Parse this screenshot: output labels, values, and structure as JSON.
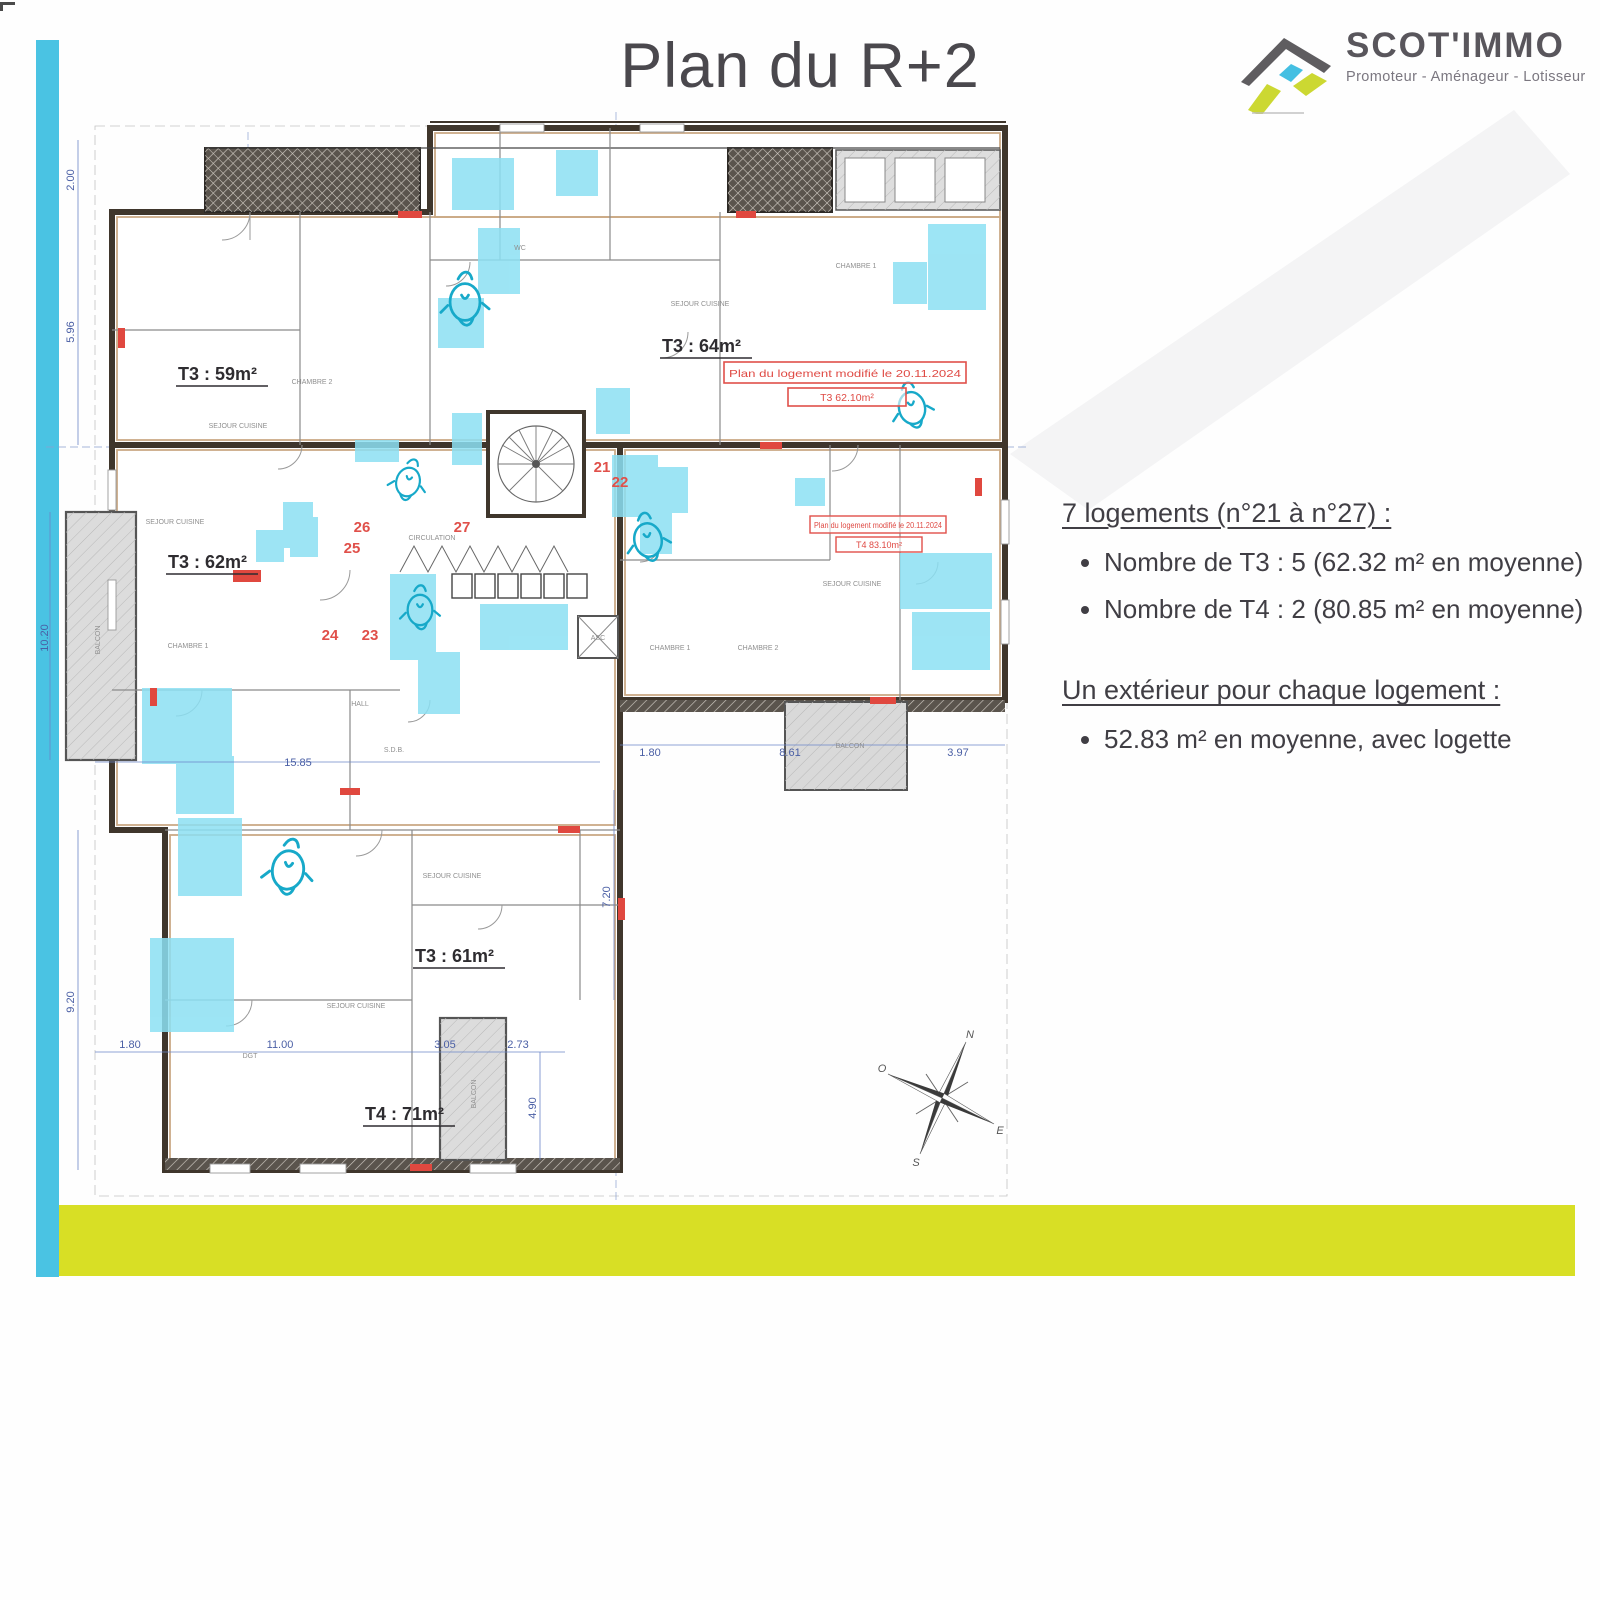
{
  "page": {
    "title": "Plan du R+2"
  },
  "logo": {
    "name": "SCOT'IMMO",
    "tagline": "Promoteur - Aménageur - Lotisseur"
  },
  "info": {
    "block1": {
      "heading": "7 logements (n°21 à n°27) :",
      "bullets": [
        "Nombre de T3 : 5 (62.32 m² en moyenne)",
        "Nombre de T4 : 2 (80.85 m² en moyenne)"
      ]
    },
    "block2": {
      "heading": "Un extérieur pour chaque logement :",
      "bullets": [
        "52.83 m² en moyenne, avec logette"
      ]
    }
  },
  "plan": {
    "apartments": [
      "T3 : 59m²",
      "T3 : 64m²",
      "T3 : 62m²",
      "T3 : 61m²",
      "T4 : 71m²"
    ],
    "units": [
      "21",
      "22",
      "23",
      "24",
      "25",
      "26",
      "27"
    ],
    "annotations": [
      {
        "line1": "Plan du logement modifié le 20.11.2024",
        "line2": "T3 62.10m²"
      },
      {
        "line1": "Plan du logement modifié le 20.11.2024",
        "line2": "T4 83.10m²"
      }
    ],
    "rooms": [
      "SEJOUR CUISINE",
      "SEJOUR CUISINE",
      "SEJOUR CUISINE",
      "SEJOUR CUISINE",
      "SEJOUR CUISINE",
      "SEJOUR CUISINE",
      "CIRCULATION",
      "CHAMBRE 1",
      "CHAMBRE 2",
      "CHAMBRE 1",
      "CHAMBRE 2",
      "CHAMBRE 1",
      "HALL",
      "BALCON",
      "BALCON",
      "BALCON",
      "S.D.B.",
      "WC",
      "ASC",
      "DGT"
    ],
    "dimensions": [
      "2.00",
      "5.96",
      "10.20",
      "9.20",
      "15.85",
      "1.80",
      "11.00",
      "3.05",
      "2.73",
      "4.90",
      "7.20",
      "1.80",
      "8.61",
      "3.97"
    ],
    "compass": {
      "n": "N",
      "o": "O",
      "e": "E",
      "s": "S"
    }
  },
  "colors": {
    "bar_blue": "#4ac3e3",
    "bar_yellow": "#d8df25",
    "highlight_cyan": "#8ce0f3",
    "annotation_red": "#e0504a",
    "wall_dark": "#3f362c"
  }
}
